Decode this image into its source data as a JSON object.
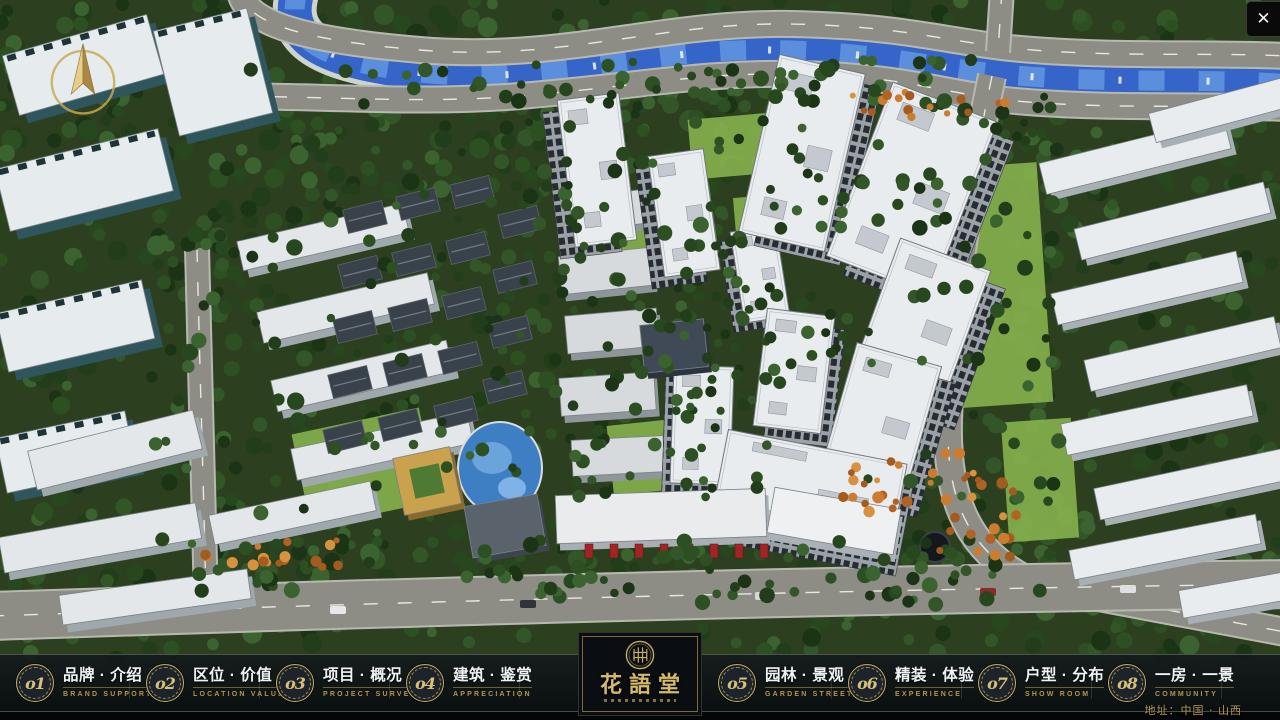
{
  "window": {
    "close_label": "✕"
  },
  "nav": {
    "items": [
      {
        "num": "o1",
        "zh": "品牌 · 介绍",
        "en": "BRAND SUPPORT"
      },
      {
        "num": "o2",
        "zh": "区位 · 价值",
        "en": "LOCATION VALUE"
      },
      {
        "num": "o3",
        "zh": "项目 · 概况",
        "en": "PROJECT SURVEY"
      },
      {
        "num": "o4",
        "zh": "建筑 · 鉴赏",
        "en": "APPRECIATION"
      },
      {
        "num": "o5",
        "zh": "园林 · 景观",
        "en": "GARDEN STREET"
      },
      {
        "num": "o6",
        "zh": "精装 · 体验",
        "en": "EXPERIENCE"
      },
      {
        "num": "o7",
        "zh": "户型 · 分布",
        "en": "SHOW ROOM"
      },
      {
        "num": "o8",
        "zh": "一房 · 一景",
        "en": "COMMUNITY"
      }
    ]
  },
  "logo": {
    "title": "花語堂"
  },
  "footer": {
    "address": "地址：中国 · 山西"
  },
  "colors": {
    "accent_gold": "#c9ad62",
    "panel_dark": "#0a0e12",
    "river_blue": "#3565c8"
  }
}
